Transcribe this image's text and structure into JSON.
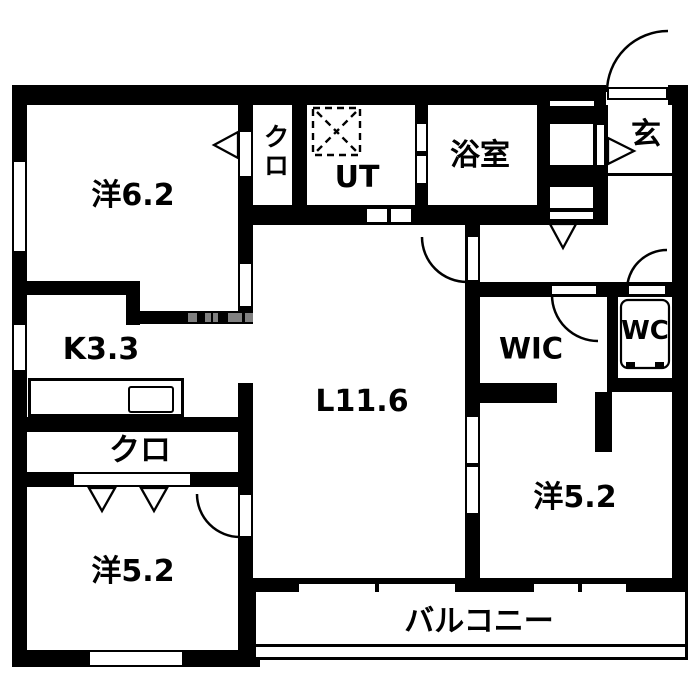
{
  "plan": {
    "rooms": {
      "western_6_2": "洋6.2",
      "closet_upper": "クロ",
      "utility": "UT",
      "bathroom": "浴室",
      "entrance": "玄",
      "kitchen": "K3.3",
      "living": "L11.6",
      "walk_in_closet": "WIC",
      "toilet": "WC",
      "closet_lower": "クロ",
      "western_5_2_left": "洋5.2",
      "western_5_2_right": "洋5.2",
      "balcony": "バルコニー"
    },
    "colors": {
      "wall": "#000000",
      "background": "#ffffff",
      "hatch": "#808080"
    }
  }
}
